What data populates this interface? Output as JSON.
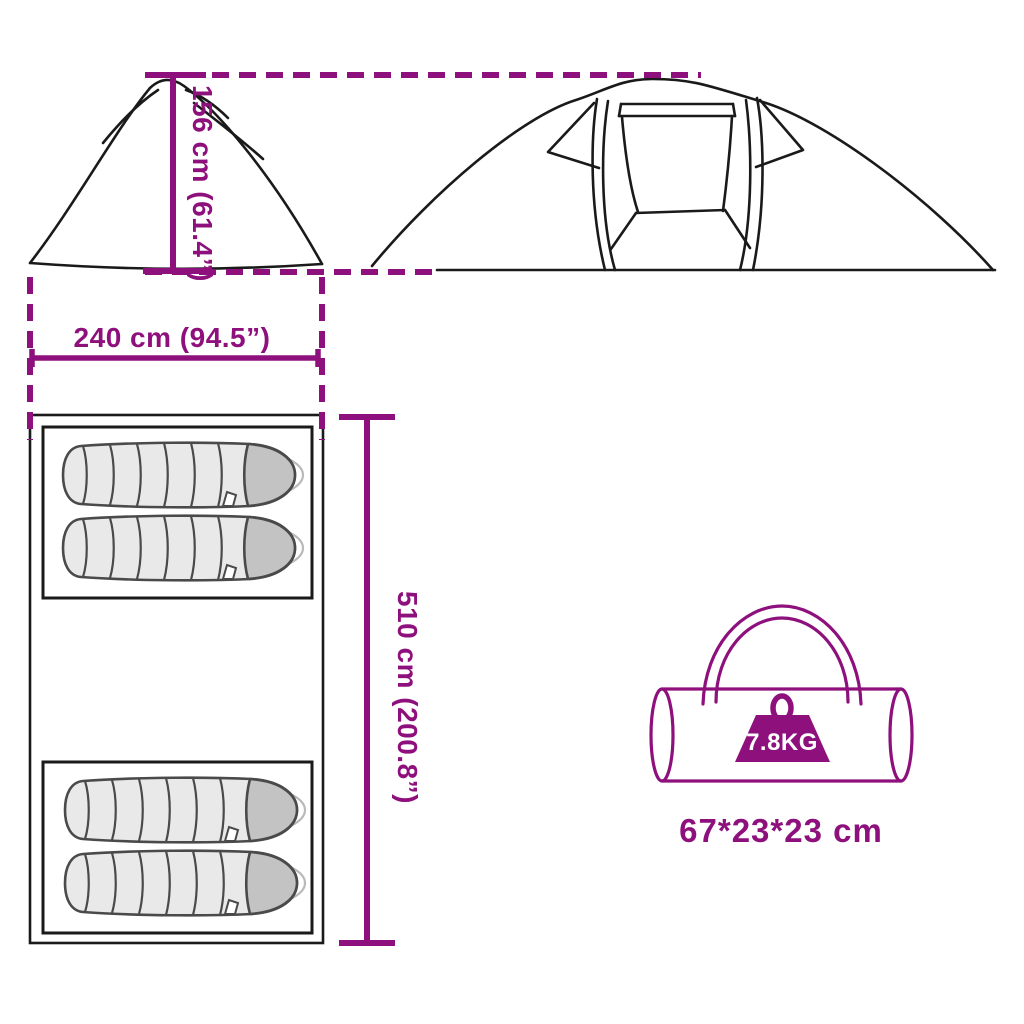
{
  "diagram": {
    "type": "product-dimension-diagram",
    "product": "camping tent with carry bag"
  },
  "labels": {
    "height": "156 cm (61.4”)",
    "width": "240 cm (94.5”)",
    "length": "510 cm (200.8”)",
    "bag_size": "67*23*23 cm",
    "weight": "7.8KG"
  },
  "floor_plan": {
    "sleeping_bags_top_room": 2,
    "sleeping_bags_bottom_room": 2
  },
  "icons": {
    "side_view": "tent-side-silhouette",
    "front_view": "tent-front-with-door",
    "floor_plan": "tent-floor-plan",
    "sleeping_bag": "sleeping-bag-top-view",
    "carry_bag": "duffel-bag-with-handle",
    "weight": "weight-block-with-ring"
  },
  "colors": {
    "accent": "#8E107C",
    "line": "#1a1a1a",
    "bag_body": "#e9e9e9",
    "bag_hood": "#c3c3c3",
    "bag_outline": "#4a4a4a",
    "bag_shadow": "#b9b9b9",
    "weight_text": "#ffffff",
    "background": "#ffffff"
  }
}
